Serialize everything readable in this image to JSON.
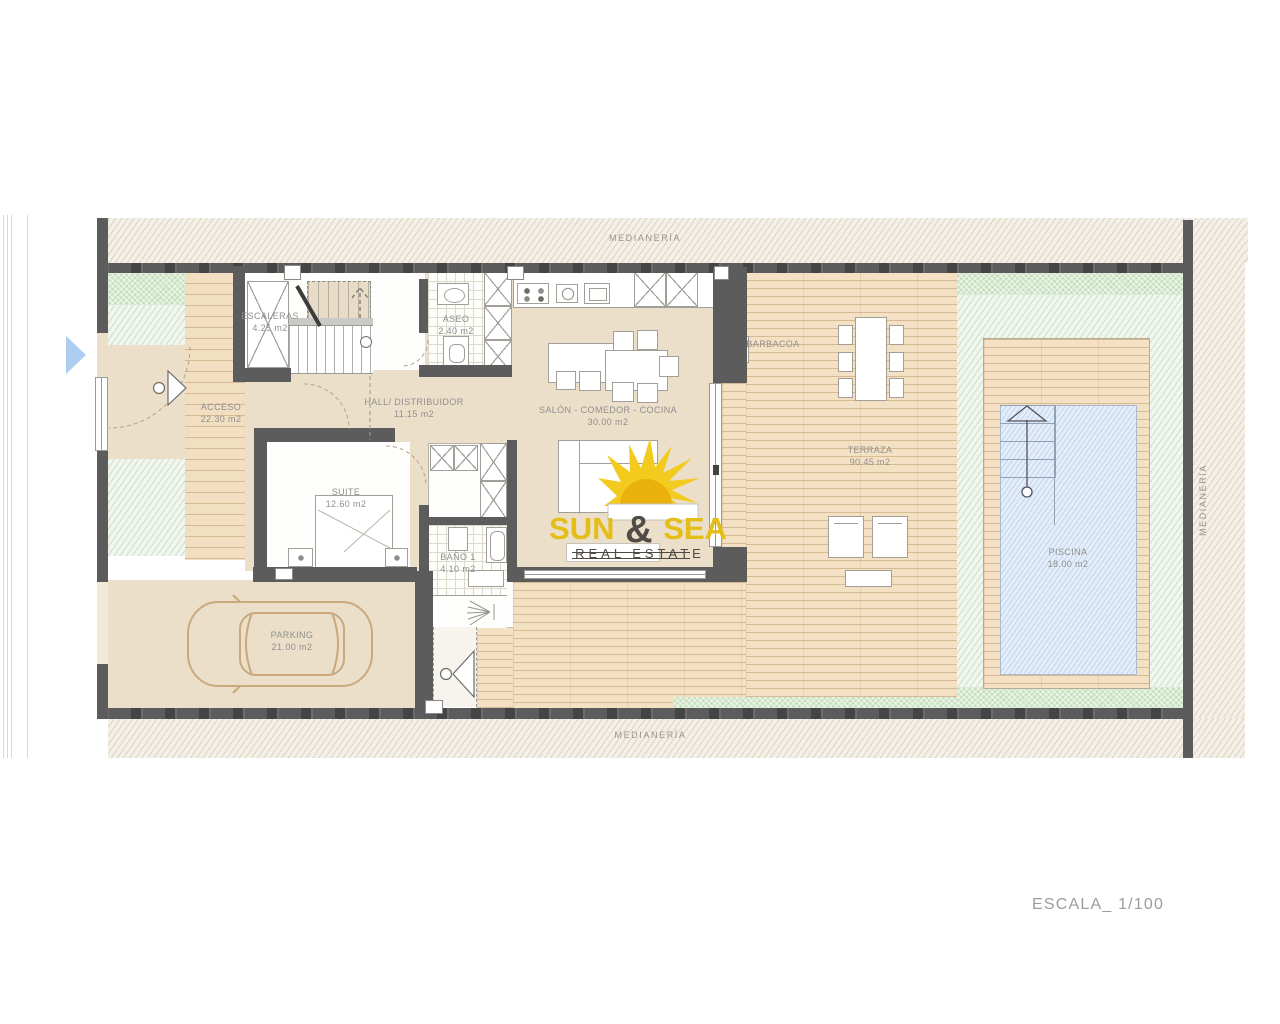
{
  "drawing": {
    "scale_label": "ESCALA_ 1/100",
    "boundaries": {
      "top": "MEDIANERÍA",
      "bottom": "MEDIANERÍA",
      "right": "MEDIANERÍA"
    }
  },
  "rooms": {
    "escaleras": {
      "label": "ESCALERAS",
      "area": "4.25 m2"
    },
    "aseo": {
      "label": "ASEO",
      "area": "2.40 m2"
    },
    "acceso": {
      "label": "ACCESO",
      "area": "22.30 m2"
    },
    "hall": {
      "label": "HALL/ DISTRIBUIDOR",
      "area": "11.15 m2"
    },
    "salon": {
      "label": "SALÓN - COMEDOR - COCINA",
      "area": "30.00 m2"
    },
    "suite": {
      "label": "SUITE",
      "area": "12.60 m2"
    },
    "bano": {
      "label": "BAÑO 1",
      "area": "4.10 m2"
    },
    "parking": {
      "label": "PARKING",
      "area": "21.00 m2"
    },
    "barbacoa": {
      "label": "BARBACOA"
    },
    "terraza": {
      "label": "TERRAZA",
      "area": "90.45 m2"
    },
    "piscina": {
      "label": "PISCINA",
      "area": "18.00 m2"
    }
  },
  "logo": {
    "word1": "SUN",
    "ampersand": "&",
    "word2": "SEA",
    "subtitle": "REAL ESTATE"
  },
  "colors": {
    "wall": "#5c5c5c",
    "logo_yellow": "#e4bd17",
    "pool_blue": "#e4eefa",
    "entry_arrow_blue": "#aacdf0"
  }
}
